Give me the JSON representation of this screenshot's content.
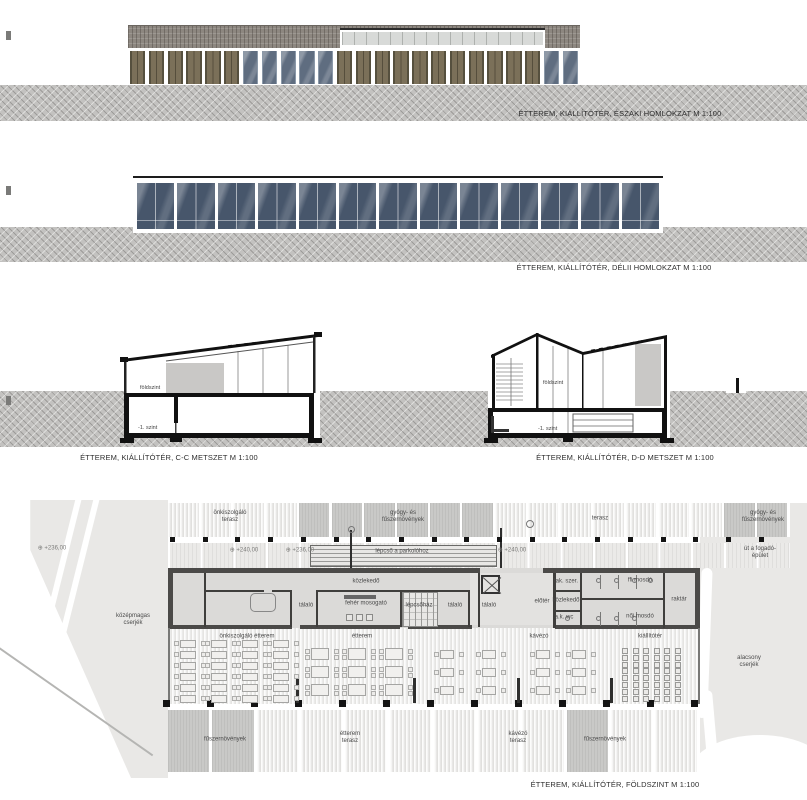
{
  "captions": {
    "north": "ÉTTEREM, KIÁLLÍTÓTÉR, ÉSZAKI HOMLOKZAT M 1:100",
    "south": "ÉTTEREM, KIÁLLÍTÓTÉR, DÉLII HOMLOKZAT M 1:100",
    "cc": "ÉTTEREM, KIÁLLÍTÓTÉR, C-C METSZET M 1:100",
    "dd": "ÉTTEREM, KIÁLLÍTÓTÉR, D-D METSZET M 1:100",
    "plan": "ÉTTEREM, KIÁLLÍTÓTÉR, FÖLDSZINT M 1:100"
  },
  "sections": {
    "cc": {
      "floor_label": "földszint",
      "basement_label": "-1. szint"
    },
    "dd": {
      "floor_label": "földszint",
      "basement_label": "-1. szint"
    }
  },
  "colors": {
    "wood_panel": "#7b7059",
    "glass_north": "#5f6d80",
    "glass_south": "#47566b",
    "roof_band": "#8d8780",
    "ground_hatch": "#c3c2c0",
    "plan_planting": "#c9c9c7",
    "plan_wall": "#4b4a48"
  },
  "north_elevation": {
    "bays": [
      "wood",
      "wood",
      "wood",
      "wood",
      "wood",
      "wood",
      "glass",
      "glass",
      "glass",
      "glass",
      "glass",
      "wood",
      "wood",
      "wood",
      "wood",
      "wood",
      "wood",
      "wood",
      "wood",
      "wood",
      "wood",
      "wood",
      "glass",
      "glass"
    ]
  },
  "south_elevation": {
    "pane_count": 13
  },
  "plan": {
    "top_band": [
      "stripe",
      "stripe",
      "stripe",
      "stripe",
      "plant",
      "plant",
      "plant",
      "plant",
      "plant",
      "plant",
      "stripe",
      "stripe",
      "stripe",
      "stripe",
      "stripe",
      "stripe",
      "stripe",
      "plant",
      "plant"
    ],
    "bottom_band": [
      "plant",
      "plant",
      "stripe",
      "stripe",
      "stripe",
      "stripe",
      "stripe",
      "stripe",
      "stripe",
      "plant",
      "stripe",
      "stripe"
    ],
    "pergola_columns": {
      "count": 19,
      "x0": 170,
      "dx": 32.7,
      "y": 537,
      "size": 5
    },
    "south_columns": {
      "count": 13,
      "x0": 163,
      "dx": 44,
      "y": 700,
      "size": 7
    },
    "dividers_x": [
      296,
      413,
      517,
      610
    ],
    "markers": [
      {
        "text": "+236,00",
        "x": 52,
        "y": 548
      },
      {
        "text": "+240,00",
        "x": 244,
        "y": 550
      },
      {
        "text": "+236,00",
        "x": 300,
        "y": 550
      },
      {
        "text": "+240,00",
        "x": 512,
        "y": 550
      }
    ],
    "labels": [
      {
        "text": "önkiszolgáló\nterasz",
        "x": 230,
        "y": 517
      },
      {
        "text": "gyógy- és\nfűszernövények",
        "x": 403,
        "y": 517
      },
      {
        "text": "terasz",
        "x": 600,
        "y": 519
      },
      {
        "text": "gyógy- és\nfűszernövények",
        "x": 763,
        "y": 517
      },
      {
        "text": "lépcső a parkolóhoz",
        "x": 402,
        "y": 552
      },
      {
        "text": "út a fogadó-\népület",
        "x": 760,
        "y": 553
      },
      {
        "text": "középmagas\ncserjék",
        "x": 133,
        "y": 620
      },
      {
        "text": "alacsony\ncserjék",
        "x": 749,
        "y": 662
      },
      {
        "text": "közlekedő",
        "x": 366,
        "y": 582
      },
      {
        "text": "tálaló",
        "x": 306,
        "y": 606
      },
      {
        "text": "fehér mosogató",
        "x": 366,
        "y": 604
      },
      {
        "text": "lépcsőház",
        "x": 419,
        "y": 606
      },
      {
        "text": "tálaló",
        "x": 455,
        "y": 606
      },
      {
        "text": "tálaló",
        "x": 489,
        "y": 606
      },
      {
        "text": "előtér",
        "x": 542,
        "y": 602
      },
      {
        "text": "tak. szer.",
        "x": 566,
        "y": 582
      },
      {
        "text": "ffi mosdó",
        "x": 640,
        "y": 581
      },
      {
        "text": "közlekedő",
        "x": 566,
        "y": 601
      },
      {
        "text": "a.k. wc",
        "x": 564,
        "y": 618
      },
      {
        "text": "női mosdó",
        "x": 640,
        "y": 617
      },
      {
        "text": "raktár",
        "x": 679,
        "y": 600
      },
      {
        "text": "önkiszolgáló étterem",
        "x": 247,
        "y": 637
      },
      {
        "text": "étterem",
        "x": 362,
        "y": 637
      },
      {
        "text": "kávézó",
        "x": 539,
        "y": 637
      },
      {
        "text": "kiállítótér",
        "x": 650,
        "y": 637
      },
      {
        "text": "fűszernövények",
        "x": 225,
        "y": 740
      },
      {
        "text": "étterem\nterasz",
        "x": 350,
        "y": 738
      },
      {
        "text": "kávézó\nterasz",
        "x": 518,
        "y": 738
      },
      {
        "text": "fűszernövények",
        "x": 605,
        "y": 740
      }
    ],
    "furniture": {
      "self_service": {
        "cols_x": [
          174,
          205,
          236,
          267
        ],
        "rows_y": [
          640,
          651,
          662,
          673,
          684,
          695
        ]
      },
      "restaurant": {
        "cols_x": [
          305,
          342,
          379
        ],
        "rows_y": [
          648,
          666,
          684
        ]
      },
      "cafe": {
        "cols_x": [
          434,
          476,
          530,
          566
        ],
        "rows_y": [
          650,
          668,
          686
        ]
      },
      "exhibition": {
        "x0": 622,
        "y0": 648,
        "cols": 6,
        "rows": 8,
        "dx": 10.6,
        "dy": 6.8
      }
    }
  }
}
